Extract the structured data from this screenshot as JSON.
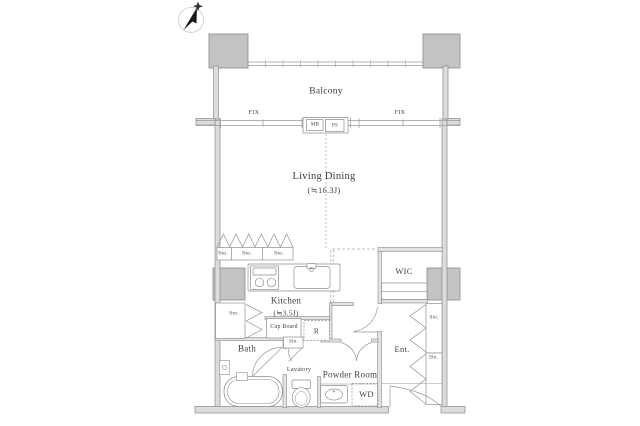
{
  "rooms": {
    "balcony": "Balcony",
    "living_dining": "Living Dining",
    "living_dining_size": "(≒16.3J)",
    "kitchen": "Kitchen",
    "kitchen_size": "(≒3.5J)",
    "bath": "Bath",
    "lavatory": "Lavatory",
    "powder_room": "Powder Room",
    "entrance": "Ent.",
    "wic": "WIC"
  },
  "fixtures": {
    "cup_board": "Cup Board",
    "refrigerator": "R",
    "washer_dryer": "WD"
  },
  "storages": [
    "Sto.",
    "Sto.",
    "Sto.",
    "Sto.",
    "Sto.",
    "Sto.",
    "Sto."
  ],
  "windows": {
    "fix": "FIX"
  },
  "utilities": {
    "mb": "MB",
    "ps": "PS"
  },
  "colors": {
    "wall_fill": "#dcdcdc",
    "pillar_fill": "#c3c3c3",
    "line": "#8a8a8a",
    "text": "#3f3f3f"
  }
}
